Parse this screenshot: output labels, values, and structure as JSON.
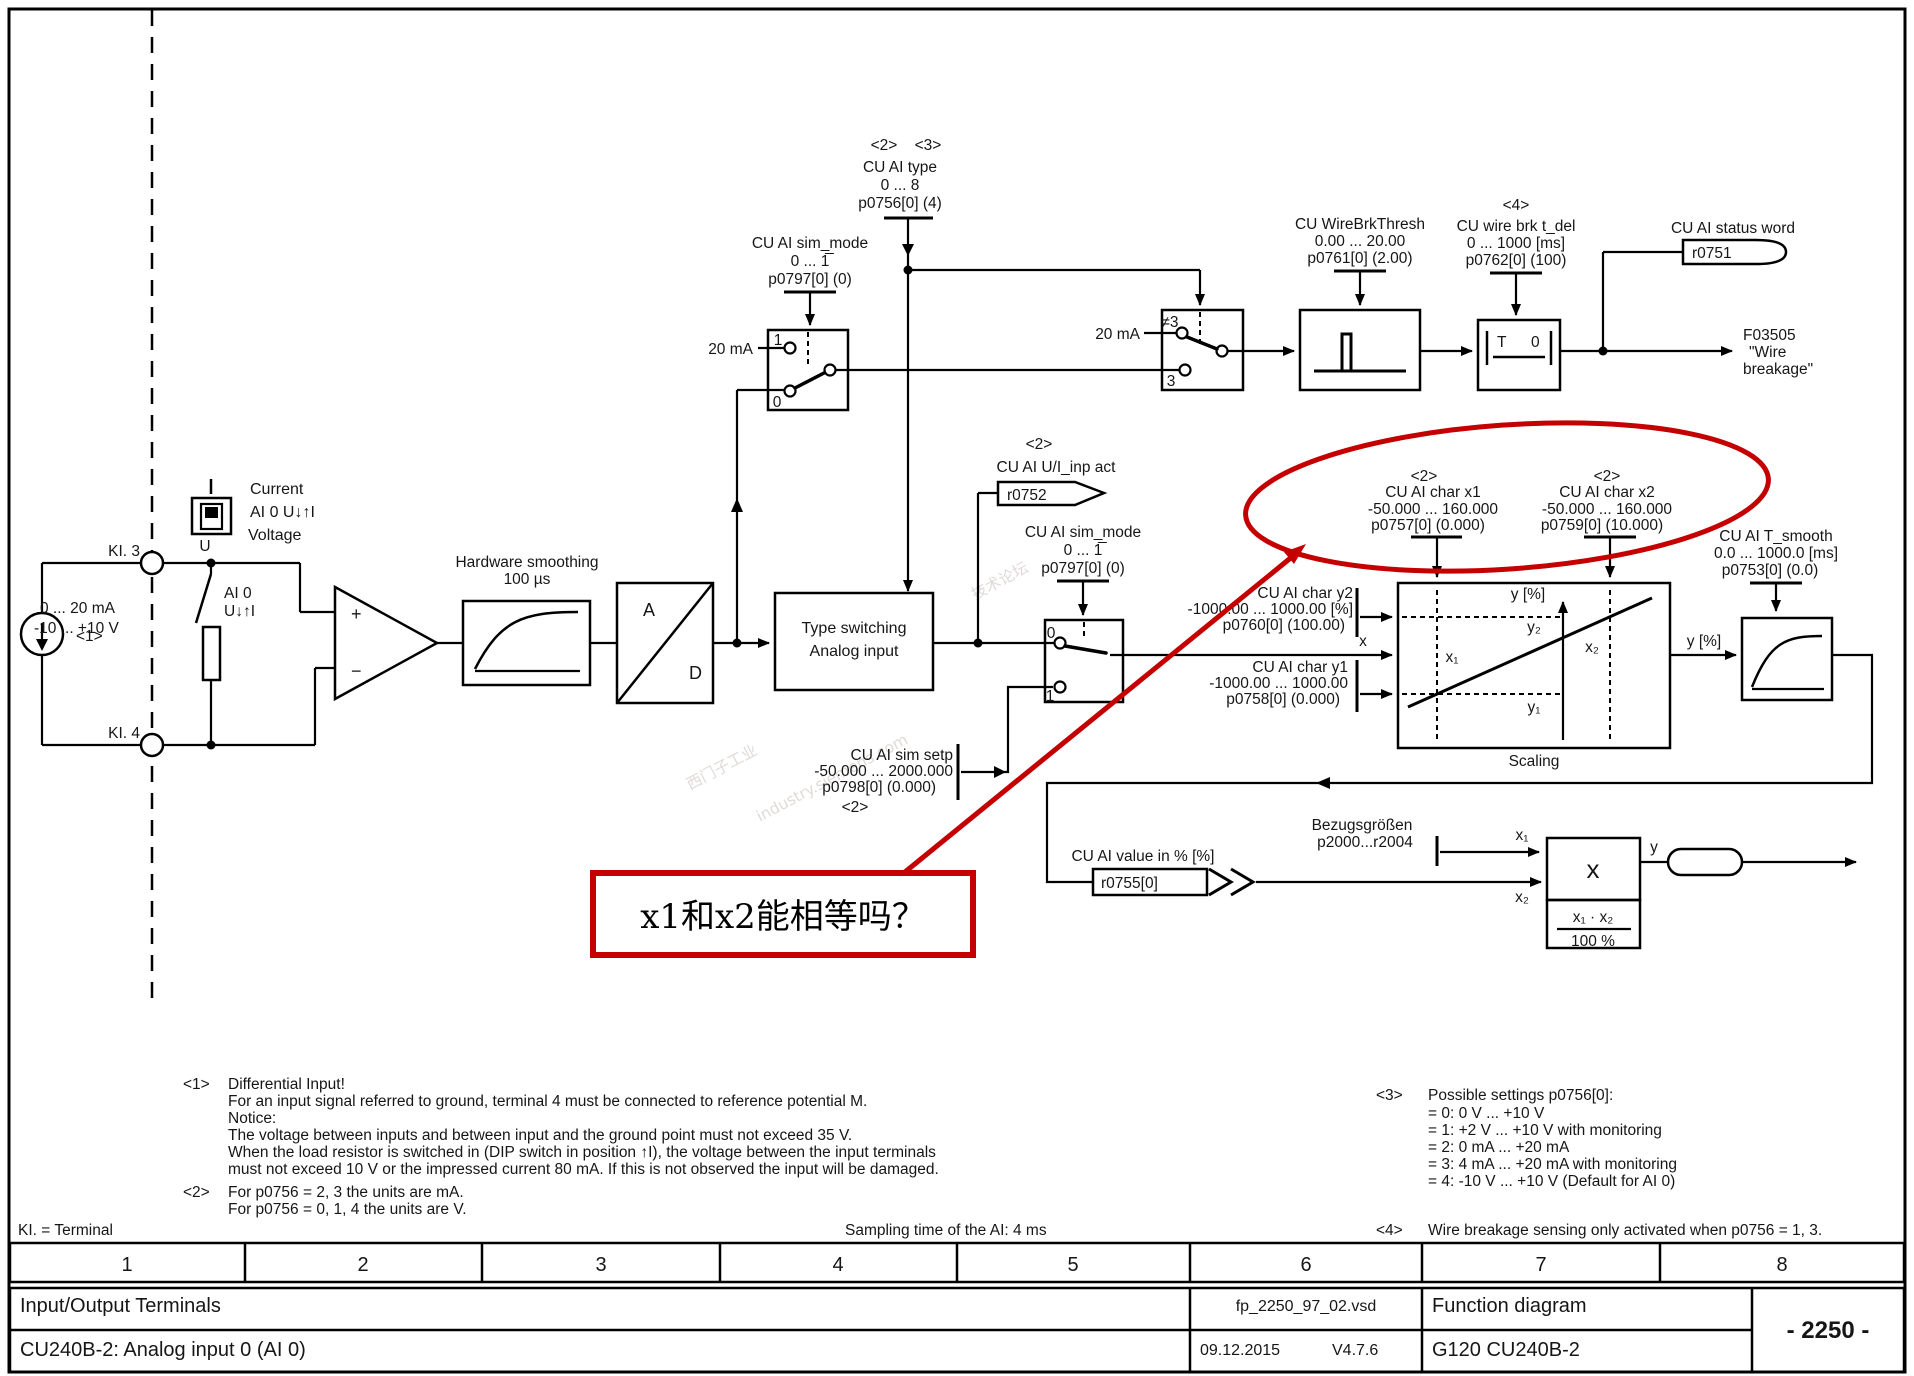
{
  "tags": {
    "t1": "<1>",
    "t2": "<2>",
    "t3": "<3>",
    "t4": "<4>"
  },
  "left": {
    "ki3": "KI. 3",
    "ki4": "KI. 4",
    "current": "Current",
    "selector": "AI 0  U↓↑I",
    "voltage": "Voltage",
    "switch_l1": "AI 0",
    "switch_l2": "U↓↑I",
    "dip_u": "U",
    "range_ma": "0 ... 20 mA",
    "range_v": "-10 ... +10 V",
    "plus": "+",
    "minus": "−"
  },
  "blocks": {
    "hw_smooth_1": "Hardware smoothing",
    "hw_smooth_2": "100 µs",
    "ad_a": "A",
    "ad_d": "D",
    "type_switch_1": "Type switching",
    "type_switch_2": "Analog input",
    "scaling": "Scaling",
    "tdel_t": "T",
    "tdel_0": "0"
  },
  "params": {
    "p0756": {
      "name": "CU AI type",
      "range": "0 ... 8",
      "value": "p0756[0] (4)"
    },
    "p0797": {
      "name": "CU AI sim_mode",
      "range": "0 ... 1̅",
      "value": "p0797[0] (0)"
    },
    "p0761": {
      "name": "CU WireBrkThresh",
      "range": "0.00 ... 20.00",
      "value": "p0761[0] (2.00)"
    },
    "p0762": {
      "name": "CU wire brk t_del",
      "range": "0 ... 1000  [ms]",
      "value": "p0762[0] (100)"
    },
    "p0757": {
      "name": "CU AI char x1",
      "range": "-50.000 ... 160.000",
      "value": "p0757[0] (0.000)"
    },
    "p0759": {
      "name": "CU AI char x2",
      "range": "-50.000 ... 160.000",
      "value": "p0759[0] (10.000)"
    },
    "p0760": {
      "name": "CU AI char y2",
      "range": "-1000.00 ... 1000.00  [%]",
      "value": "p0760[0] (100.00)"
    },
    "p0758": {
      "name": "CU AI char y1",
      "range": "-1000.00 ... 1000.00",
      "value": "p0758[0] (0.000)"
    },
    "p0798": {
      "name": "CU AI sim setp",
      "range": "-50.000 ... 2000.000",
      "value": "p0798[0] (0.000)"
    },
    "p0753": {
      "name": "CU AI T_smooth",
      "range": "0.0 ... 1000.0  [ms]",
      "value": "p0753[0] (0.0)"
    },
    "p2000": {
      "name": "Bezugsgrößen",
      "value": "p2000...r2004"
    }
  },
  "connectors": {
    "r0751": {
      "label": "CU AI status word",
      "id": "r0751"
    },
    "r0752": {
      "label": "CU AI U/I_inp act",
      "id": "r0752"
    },
    "r0755": {
      "label": "CU AI value in % [%]",
      "id": "r0755[0]"
    },
    "fault_1": "F03505",
    "fault_2": "\"Wire",
    "fault_3": "breakage\""
  },
  "inline": {
    "ma20": "20 mA",
    "sel1_1": "1",
    "sel1_0": "0",
    "sel2_ne3": "≠3",
    "sel2_3": "3",
    "sim_0": "0",
    "sim_1": "1",
    "x": "x",
    "y": "y",
    "y_pct": "y [%]",
    "x1": "x₁",
    "x2": "x₂",
    "y1": "y₁",
    "y2": "y₂",
    "mult": "x",
    "frac_num": "x₁ · x₂",
    "frac_den": "100 %"
  },
  "annotation": {
    "question": "x1和x2能相等吗？"
  },
  "watermark": {
    "w1": "西门子工业",
    "w2": "industry.siemens.com",
    "w3": "技术论坛"
  },
  "footnotes": {
    "fn1_l1": "Differential Input!",
    "fn1_l2": "For an input signal referred to ground, terminal 4 must be connected to reference potential M.",
    "fn1_l3": "Notice:",
    "fn1_l4": "The voltage between inputs and between input and the ground point must not exceed 35 V.",
    "fn1_l5": "When the load resistor is switched in (DIP switch in position ↑I), the voltage between the input terminals",
    "fn1_l6": "must not exceed 10 V or the impressed current 80 mA. If this is not observed the input will be damaged.",
    "fn2_l1": "For p0756 = 2, 3 the units are mA.",
    "fn2_l2": "For p0756 = 0, 1, 4 the units are V.",
    "fn3_l0": "Possible settings p0756[0]:",
    "fn3_l1": "= 0:  0 V ... +10 V",
    "fn3_l2": "= 1:  +2 V ... +10 V with monitoring",
    "fn3_l3": "= 2:  0 mA ... +20 mA",
    "fn3_l4": "= 3:  4 mA ... +20 mA with monitoring",
    "fn3_l5": "= 4:  -10 V ... +10 V (Default for AI 0)",
    "fn4": "Wire breakage sensing only activated when p0756 = 1, 3.",
    "ki_terminal": "KI. = Terminal",
    "sampling": "Sampling time of the AI: 4 ms"
  },
  "titleblock": {
    "columns": [
      "1",
      "2",
      "3",
      "4",
      "5",
      "6",
      "7",
      "8"
    ],
    "doc_title": "Input/Output Terminals",
    "file": "fp_2250_97_02.vsd",
    "kind": "Function diagram",
    "page": "- 2250 -",
    "subtitle": "CU240B-2: Analog input 0 (AI 0)",
    "date": "09.12.2015",
    "version": "V4.7.6",
    "product": "G120 CU240B-2"
  }
}
